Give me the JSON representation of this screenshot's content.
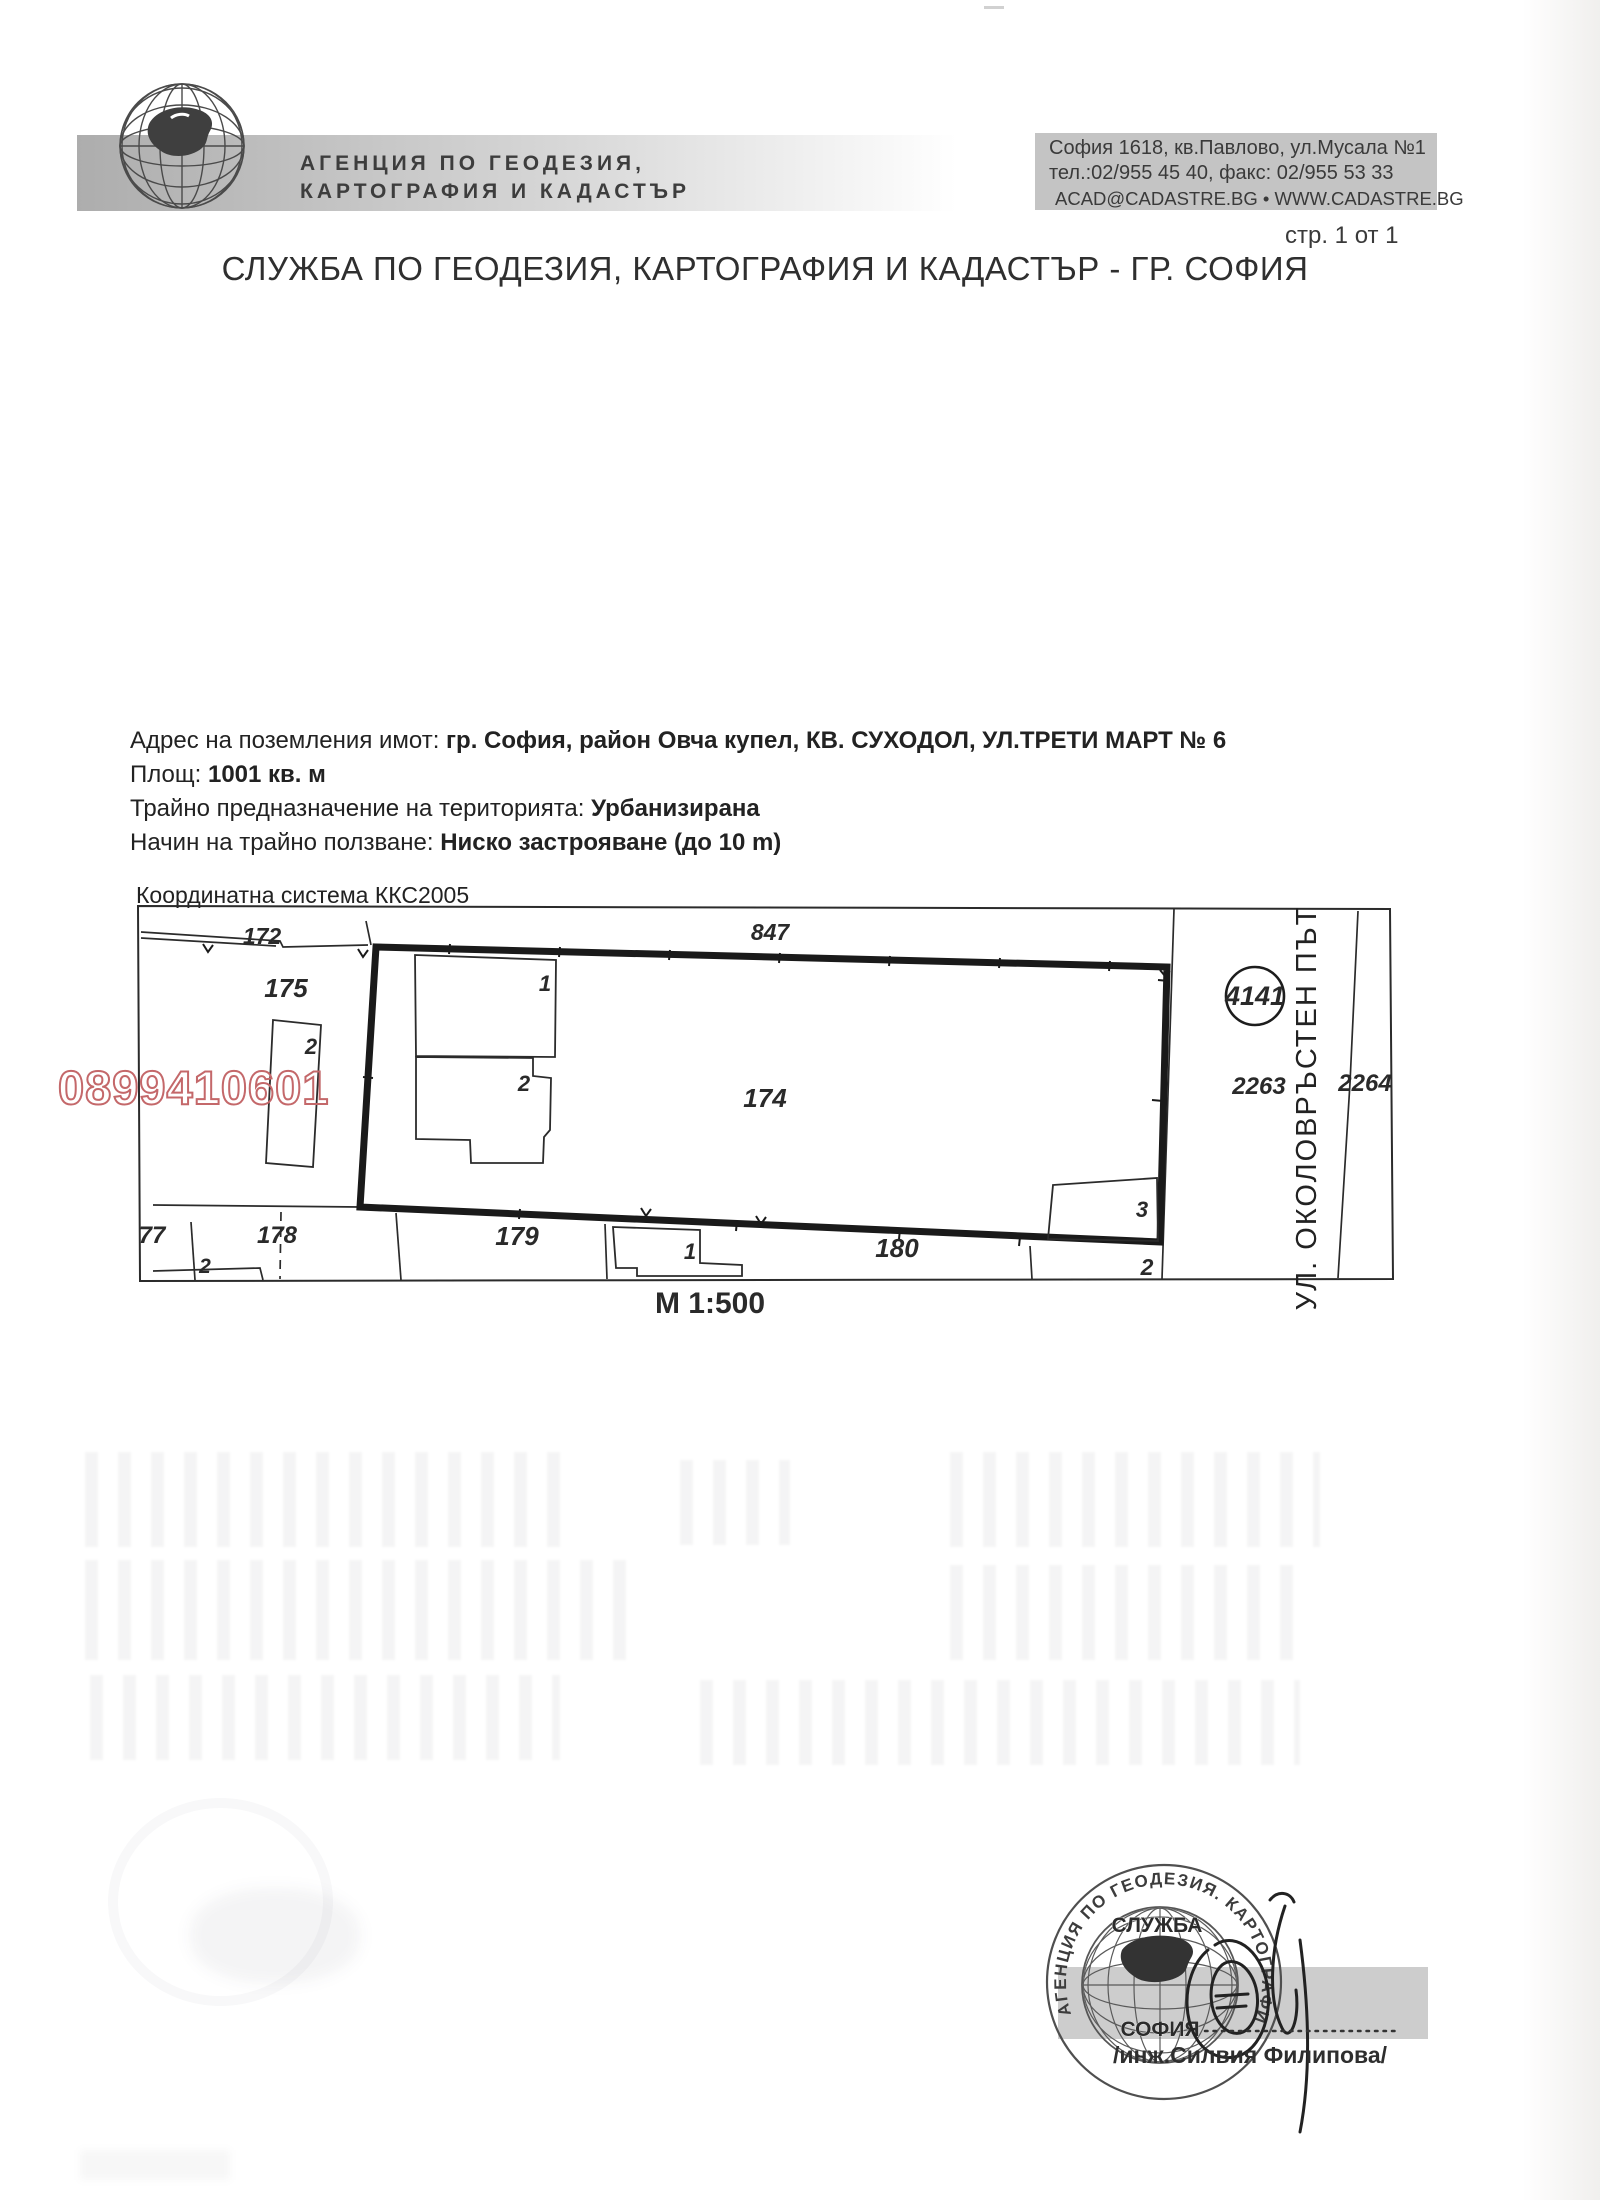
{
  "document": {
    "page_label": "стр. 1 от 1",
    "title": "СЛУЖБА ПО ГЕОДЕЗИЯ, КАРТОГРАФИЯ И КАДАСТЪР - ГР. СОФИЯ"
  },
  "header": {
    "agency_name_line1": "АГЕНЦИЯ ПО ГЕОДЕЗИЯ,",
    "agency_name_line2": "КАРТОГРАФИЯ И КАДАСТЪР",
    "contact_line1": "София 1618, кв.Павлово, ул.Мусала №1",
    "contact_line2": "тел.:02/955 45 40, факс: 02/955 53 33",
    "contact_line3": "ACAD@CADASTRE.BG • WWW.CADASTRE.BG"
  },
  "property": {
    "address_label": "Адрес на поземления имот:",
    "address_value": "гр. София, район Овча купел, КВ. СУХОДОЛ, УЛ.ТРЕТИ МАРТ № 6",
    "area_label": "Площ:",
    "area_value": "1001 кв. м",
    "territory_label": "Трайно предназначение на територията:",
    "territory_value": "Урбанизирана",
    "usage_label": "Начин на трайно ползване:",
    "usage_value": "Ниско застрояване (до 10 m)"
  },
  "map": {
    "coordinate_system": "Координатна система ККС2005",
    "scale_label": "М 1:500",
    "watermark_number": "0899410601",
    "street_name": "УЛ. ОКОЛОВРЪСТЕН ПЪТ",
    "survey_point": "4141",
    "labels": {
      "parcel_172": "172",
      "parcel_847": "847",
      "parcel_175": "175",
      "parcel_174": "174",
      "parcel_77": "77",
      "parcel_178": "178",
      "parcel_179": "179",
      "parcel_180": "180",
      "parcel_2263": "2263",
      "parcel_2264": "2264",
      "building_175_2": "2",
      "building_174_1": "1",
      "building_174_2": "2",
      "building_174_3": "3",
      "building_180_1": "1",
      "subparcel_2_left": "2",
      "subparcel_2_right": "2"
    }
  },
  "stamp": {
    "ring_text": "АГЕНЦИЯ ПО ГЕОДЕЗИЯ. КАРТОГРАФИЯ И КАДАСТЪР",
    "banner_top": "СЛУЖБА",
    "banner_bottom": "СОФИЯ",
    "signed_by": "/инж.Силвия Филипова/"
  },
  "colors": {
    "watermark": "#c4686a",
    "header_band": "#bdbdbd",
    "contact_band": "#c4c4c4",
    "map_ink": "#1d1d1d"
  }
}
